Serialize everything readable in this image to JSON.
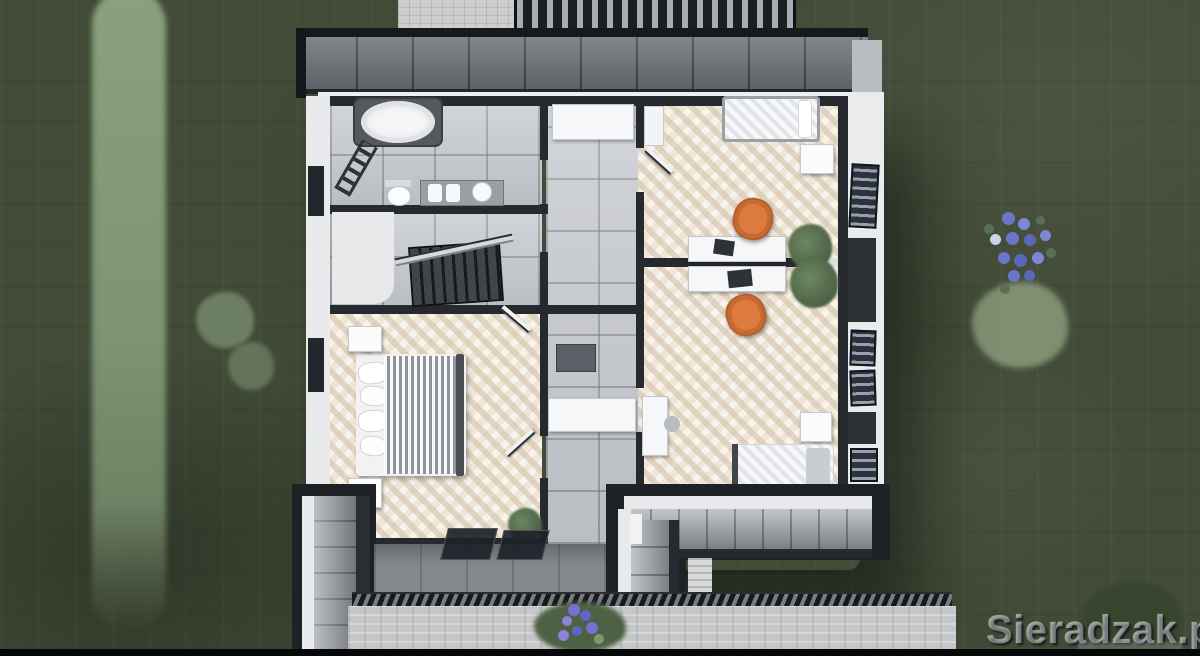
{
  "watermark": {
    "text": "Sieradzak.pl"
  },
  "scene": {
    "description": "Aerial 3D render of a house upper-floor plan surrounded by lawn",
    "environment": [
      "lawn",
      "hedge-row",
      "shrubs",
      "blue-flower-patch",
      "slatted-fence",
      "paver-patio",
      "terrace",
      "drain-grate",
      "paver-walkway"
    ],
    "house": {
      "roof_parts": [
        "top-eave-band",
        "left-lower-roof-wing",
        "right-lower-roof-wing",
        "entrance-glass-canopy",
        "gable-side"
      ],
      "rooms": [
        {
          "id": "bathroom",
          "floor": "gray-tile",
          "furniture": [
            "oval-bathtub",
            "towel-ladder",
            "toilet",
            "double-vanity"
          ]
        },
        {
          "id": "stair-hall",
          "floor": "gray-tile",
          "furniture": [
            "staircase",
            "stair-railing"
          ]
        },
        {
          "id": "bedroom-left",
          "floor": "herringbone-wood",
          "furniture": [
            "double-bed-striped",
            "pillows",
            "nightstand",
            "nightstand",
            "plant",
            "open-door",
            "open-door"
          ]
        },
        {
          "id": "corridor",
          "floor": "gray-tile",
          "furniture": [
            "cabinet",
            "dresser",
            "wardrobe"
          ]
        },
        {
          "id": "bedroom-top-right",
          "floor": "herringbone-wood",
          "furniture": [
            "single-bed",
            "nightstand",
            "desk",
            "laptop",
            "orange-office-chair",
            "plant",
            "open-door",
            "wall-shelf"
          ]
        },
        {
          "id": "bedroom-bottom-right",
          "floor": "herringbone-wood",
          "furniture": [
            "single-bed",
            "pillow",
            "nightstand",
            "desk",
            "laptop",
            "orange-office-chair",
            "side-desk",
            "plant"
          ]
        }
      ],
      "right_wall_windows": 4,
      "left_wall_windows": 2
    }
  },
  "palette": {
    "grass": "#414b37",
    "hedge": "#87997c",
    "roof_dark": "#1e2126",
    "roof_slope": "#73767d",
    "wall_white": "#edeff0",
    "wall_dark": "#26292e",
    "tile_gray": "#c8cbd0",
    "wood_floor": "#f0e6d7",
    "chair_orange": "#dd7a3e",
    "flower_blue": "#6f79c9"
  }
}
